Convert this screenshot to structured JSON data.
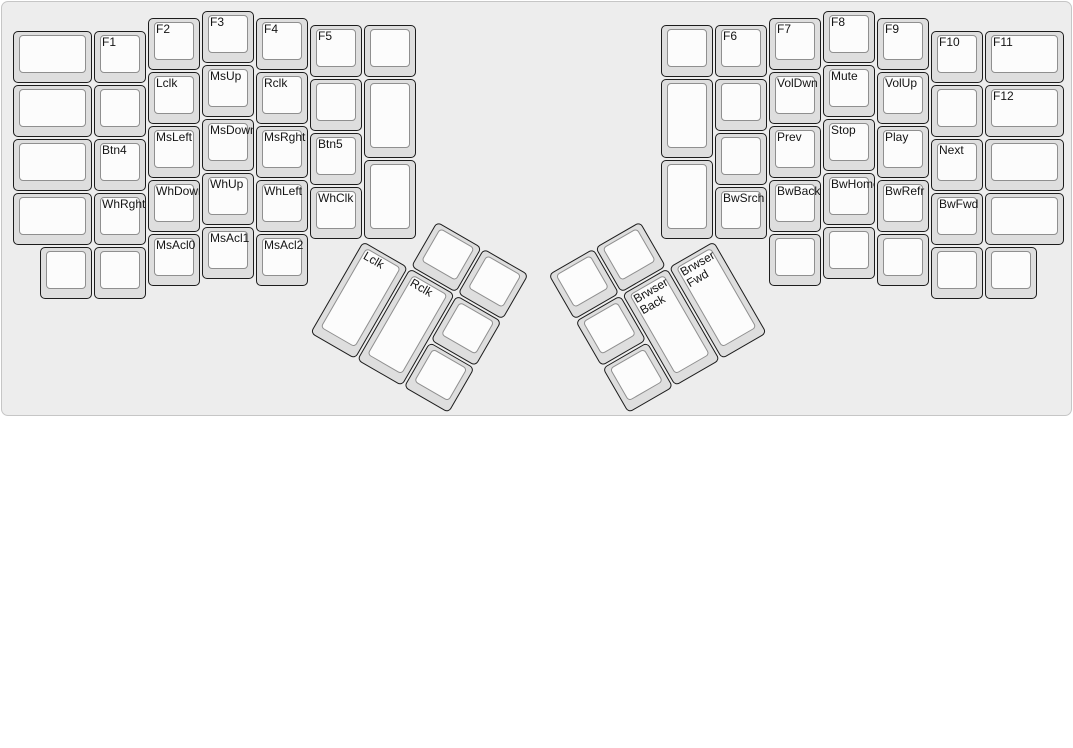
{
  "app": {
    "view_title": "ErgoDox media and mouse layer keyboard layout"
  },
  "board": {
    "unit_px": 54,
    "origin": {
      "x": 10,
      "y": 8
    },
    "background_color": "#ededed",
    "border_color": "#c6c6c6",
    "key_side_color": "#dedede",
    "key_top_color": "#fcfcfc",
    "key_border_color": "#1c1c1c",
    "key_top_border_color": "#8f8f8f",
    "label_color": "#141414"
  },
  "clusters": [
    {
      "name": "left-main",
      "rotation": 0,
      "keys": [
        {
          "x": 0,
          "y": 0.375,
          "w": 1.5,
          "label": ""
        },
        {
          "x": 1.5,
          "y": 0.375,
          "label": "F1"
        },
        {
          "x": 2.5,
          "y": 0.125,
          "label": "F2"
        },
        {
          "x": 3.5,
          "y": 0,
          "label": "F3"
        },
        {
          "x": 4.5,
          "y": 0.125,
          "label": "F4"
        },
        {
          "x": 5.5,
          "y": 0.25,
          "label": "F5"
        },
        {
          "x": 6.5,
          "y": 0.25,
          "label": ""
        },
        {
          "x": 0,
          "y": 1.375,
          "w": 1.5,
          "label": ""
        },
        {
          "x": 1.5,
          "y": 1.375,
          "label": ""
        },
        {
          "x": 2.5,
          "y": 1.125,
          "label": "Lclk"
        },
        {
          "x": 3.5,
          "y": 1,
          "label": "MsUp"
        },
        {
          "x": 4.5,
          "y": 1.125,
          "label": "Rclk"
        },
        {
          "x": 5.5,
          "y": 1.25,
          "label": ""
        },
        {
          "x": 6.5,
          "y": 1.25,
          "h": 1.5,
          "label": ""
        },
        {
          "x": 0,
          "y": 2.375,
          "w": 1.5,
          "label": ""
        },
        {
          "x": 1.5,
          "y": 2.375,
          "label": "Btn4"
        },
        {
          "x": 2.5,
          "y": 2.125,
          "label": "MsLeft"
        },
        {
          "x": 3.5,
          "y": 2,
          "label": "MsDown"
        },
        {
          "x": 4.5,
          "y": 2.125,
          "label": "MsRght"
        },
        {
          "x": 5.5,
          "y": 2.25,
          "label": "Btn5"
        },
        {
          "x": 0,
          "y": 3.375,
          "w": 1.5,
          "label": ""
        },
        {
          "x": 1.5,
          "y": 3.375,
          "label": "WhRght"
        },
        {
          "x": 2.5,
          "y": 3.125,
          "label": "WhDown"
        },
        {
          "x": 3.5,
          "y": 3,
          "label": "WhUp"
        },
        {
          "x": 4.5,
          "y": 3.125,
          "label": "WhLeft"
        },
        {
          "x": 5.5,
          "y": 3.25,
          "label": "WhClk"
        },
        {
          "x": 6.5,
          "y": 2.75,
          "h": 1.5,
          "label": ""
        },
        {
          "x": 0.5,
          "y": 4.375,
          "label": ""
        },
        {
          "x": 1.5,
          "y": 4.375,
          "label": ""
        },
        {
          "x": 2.5,
          "y": 4.125,
          "label": "MsAcl0"
        },
        {
          "x": 3.5,
          "y": 4,
          "label": "MsAcl1"
        },
        {
          "x": 4.5,
          "y": 4.125,
          "label": "MsAcl2"
        }
      ]
    },
    {
      "name": "right-main",
      "rotation": 0,
      "keys": [
        {
          "x": 12,
          "y": 0.25,
          "label": ""
        },
        {
          "x": 13,
          "y": 0.25,
          "label": "F6"
        },
        {
          "x": 14,
          "y": 0.125,
          "label": "F7"
        },
        {
          "x": 15,
          "y": 0,
          "label": "F8"
        },
        {
          "x": 16,
          "y": 0.125,
          "label": "F9"
        },
        {
          "x": 17,
          "y": 0.375,
          "label": "F10"
        },
        {
          "x": 18,
          "y": 0.375,
          "w": 1.5,
          "label": "F11"
        },
        {
          "x": 12,
          "y": 1.25,
          "h": 1.5,
          "label": ""
        },
        {
          "x": 13,
          "y": 1.25,
          "label": ""
        },
        {
          "x": 14,
          "y": 1.125,
          "label": "VolDwn"
        },
        {
          "x": 15,
          "y": 1,
          "label": "Mute"
        },
        {
          "x": 16,
          "y": 1.125,
          "label": "VolUp"
        },
        {
          "x": 17,
          "y": 1.375,
          "label": ""
        },
        {
          "x": 18,
          "y": 1.375,
          "w": 1.5,
          "label": "F12"
        },
        {
          "x": 12,
          "y": 2.75,
          "h": 1.5,
          "label": ""
        },
        {
          "x": 13,
          "y": 2.25,
          "label": ""
        },
        {
          "x": 14,
          "y": 2.125,
          "label": "Prev"
        },
        {
          "x": 15,
          "y": 2,
          "label": "Stop"
        },
        {
          "x": 16,
          "y": 2.125,
          "label": "Play"
        },
        {
          "x": 17,
          "y": 2.375,
          "label": "Next"
        },
        {
          "x": 18,
          "y": 2.375,
          "w": 1.5,
          "label": ""
        },
        {
          "x": 13,
          "y": 3.25,
          "label": "BwSrch"
        },
        {
          "x": 14,
          "y": 3.125,
          "label": "BwBack"
        },
        {
          "x": 15,
          "y": 3,
          "label": "BwHome"
        },
        {
          "x": 16,
          "y": 3.125,
          "label": "BwRefr"
        },
        {
          "x": 17,
          "y": 3.375,
          "label": "BwFwd"
        },
        {
          "x": 18,
          "y": 3.375,
          "w": 1.5,
          "label": ""
        },
        {
          "x": 14,
          "y": 4.125,
          "label": ""
        },
        {
          "x": 15,
          "y": 4,
          "label": ""
        },
        {
          "x": 16,
          "y": 4.125,
          "label": ""
        },
        {
          "x": 17,
          "y": 4.375,
          "label": ""
        },
        {
          "x": 18,
          "y": 4.375,
          "label": ""
        }
      ]
    },
    {
      "name": "left-thumb",
      "rotation": 30,
      "rx": 6.5,
      "ry": 4.25,
      "keys": [
        {
          "x": 1,
          "y": -1,
          "label": ""
        },
        {
          "x": 2,
          "y": -1,
          "label": ""
        },
        {
          "x": 0,
          "y": 0,
          "h": 2,
          "label": "Lclk"
        },
        {
          "x": 1,
          "y": 0,
          "h": 2,
          "label": "Rclk"
        },
        {
          "x": 2,
          "y": 0,
          "label": ""
        },
        {
          "x": 2,
          "y": 1,
          "label": ""
        }
      ]
    },
    {
      "name": "right-thumb",
      "rotation": -30,
      "rx": 13,
      "ry": 4.25,
      "keys": [
        {
          "x": -3,
          "y": -1,
          "label": ""
        },
        {
          "x": -2,
          "y": -1,
          "label": ""
        },
        {
          "x": -3,
          "y": 0,
          "label": ""
        },
        {
          "x": -2,
          "y": 0,
          "h": 2,
          "label": "Brwser\nBack"
        },
        {
          "x": -1,
          "y": 0,
          "h": 2,
          "label": "Brwser\nFwd"
        },
        {
          "x": -3,
          "y": 1,
          "label": ""
        }
      ]
    }
  ]
}
